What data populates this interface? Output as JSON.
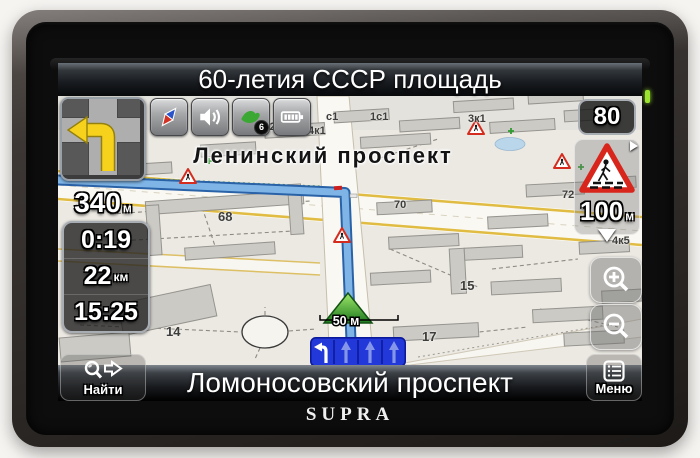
{
  "device": {
    "brand": "SUPRA"
  },
  "top_bar": {
    "next_street": "60-летия СССР площадь"
  },
  "toolbar": {
    "icons": [
      "compass",
      "speaker",
      "gps-satellite",
      "battery"
    ],
    "gps_satellite_count": "6"
  },
  "nav_info": {
    "next_maneuver_distance": "340",
    "next_maneuver_distance_unit": "м",
    "time_remaining": "0:19",
    "distance_remaining": "22",
    "distance_remaining_unit": "км",
    "arrival_time": "15:25"
  },
  "speed_camera": {
    "speed_limit": "80",
    "distance": "100",
    "distance_unit": "м"
  },
  "bottom_bar": {
    "find_label": "Найти",
    "current_street": "Ломоносовский проспект",
    "menu_label": "Меню"
  },
  "map": {
    "road_label": "Ленинский проспект",
    "car_distance_label": "50 м",
    "building_labels": [
      "4к2",
      "4к1",
      "1с1",
      "3к1",
      "71",
      "3",
      "68",
      "70",
      "14",
      "17",
      "15",
      "4к5",
      "72",
      "с1"
    ]
  },
  "colors": {
    "route": "#7fb5e6",
    "lane_panel": "#2238d8",
    "sign_red": "#d8261c",
    "led": "#9be32f"
  }
}
